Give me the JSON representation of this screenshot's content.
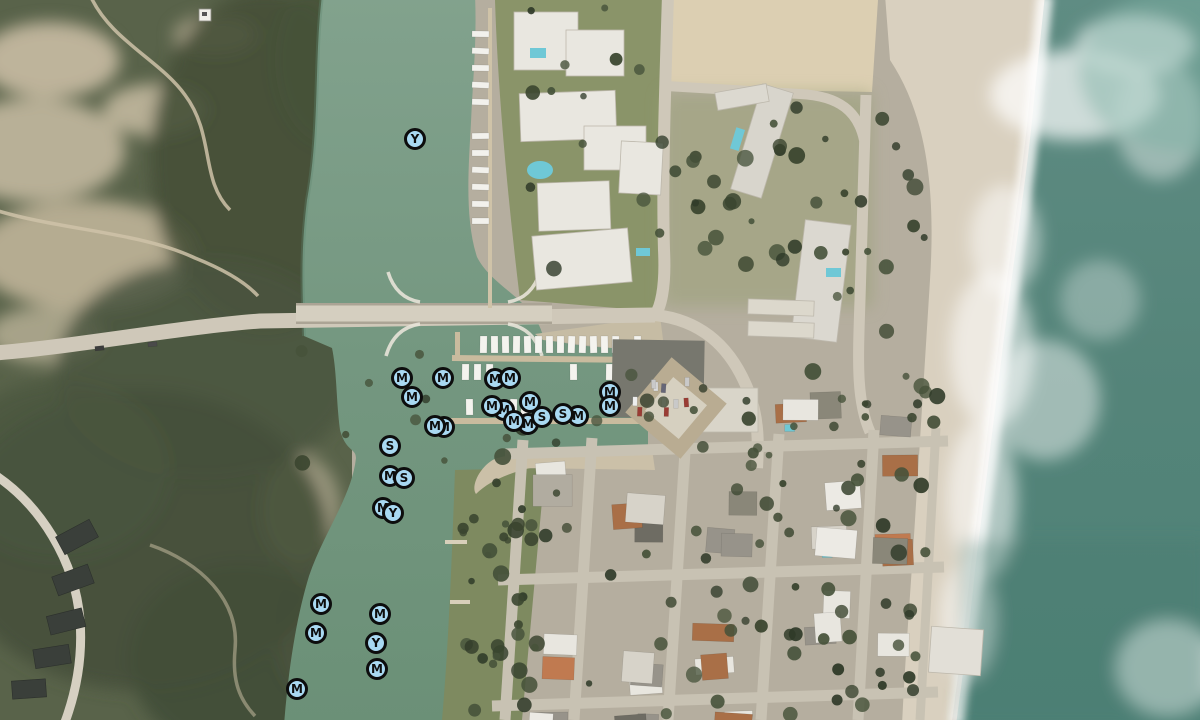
{
  "map": {
    "view": "satellite",
    "marker_style": {
      "fill": "#a9d9f2",
      "ring": "#0d0d0d",
      "letter_color": "#0d0d0d"
    },
    "marker_types": [
      "M",
      "S",
      "Y"
    ],
    "markers": [
      {
        "label": "Y",
        "x": 415,
        "y": 139
      },
      {
        "label": "M",
        "x": 402,
        "y": 378
      },
      {
        "label": "M",
        "x": 443,
        "y": 378
      },
      {
        "label": "M",
        "x": 495,
        "y": 379
      },
      {
        "label": "M",
        "x": 510,
        "y": 378
      },
      {
        "label": "M",
        "x": 412,
        "y": 397
      },
      {
        "label": "M",
        "x": 610,
        "y": 392
      },
      {
        "label": "M",
        "x": 610,
        "y": 406
      },
      {
        "label": "M",
        "x": 530,
        "y": 402
      },
      {
        "label": "M",
        "x": 504,
        "y": 410
      },
      {
        "label": "M",
        "x": 492,
        "y": 406
      },
      {
        "label": "M",
        "x": 528,
        "y": 424
      },
      {
        "label": "M",
        "x": 514,
        "y": 421
      },
      {
        "label": "M",
        "x": 578,
        "y": 416
      },
      {
        "label": "S",
        "x": 563,
        "y": 414
      },
      {
        "label": "S",
        "x": 542,
        "y": 417
      },
      {
        "label": "M",
        "x": 444,
        "y": 427
      },
      {
        "label": "M",
        "x": 435,
        "y": 426
      },
      {
        "label": "S",
        "x": 390,
        "y": 446
      },
      {
        "label": "M",
        "x": 390,
        "y": 476
      },
      {
        "label": "S",
        "x": 404,
        "y": 478
      },
      {
        "label": "M",
        "x": 383,
        "y": 508
      },
      {
        "label": "Y",
        "x": 393,
        "y": 513
      },
      {
        "label": "M",
        "x": 321,
        "y": 604
      },
      {
        "label": "M",
        "x": 380,
        "y": 614
      },
      {
        "label": "M",
        "x": 316,
        "y": 633
      },
      {
        "label": "Y",
        "x": 376,
        "y": 643
      },
      {
        "label": "M",
        "x": 377,
        "y": 669
      },
      {
        "label": "M",
        "x": 297,
        "y": 689
      }
    ]
  }
}
